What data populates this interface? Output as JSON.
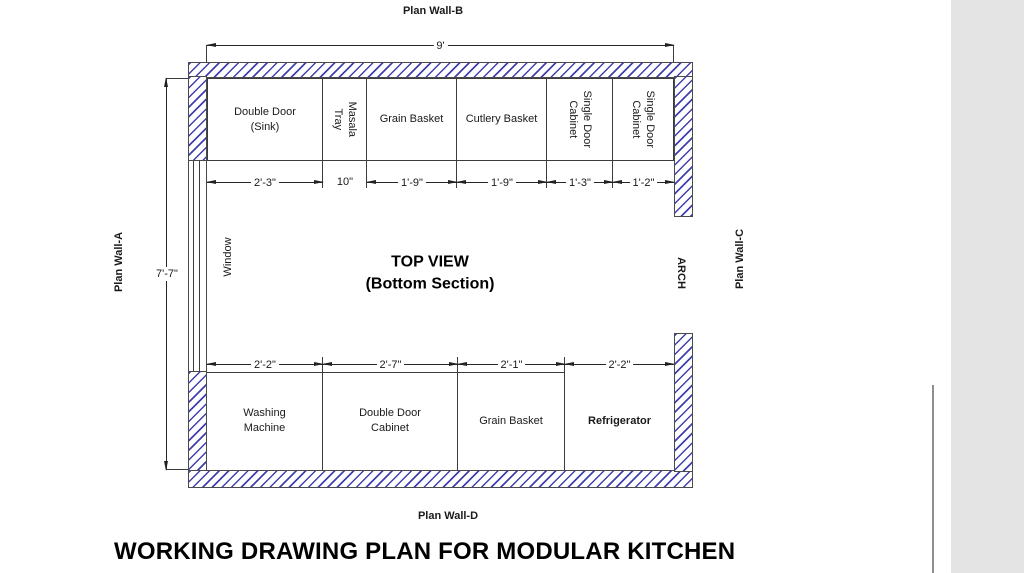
{
  "drawing": {
    "sheet_title": "WORKING DRAWING PLAN FOR MODULAR KITCHEN",
    "view_title": "TOP VIEW\n(Bottom Section)",
    "walls": {
      "top": "Plan Wall-B",
      "left": "Plan Wall-A",
      "right": "Plan Wall-C",
      "bottom": "Plan Wall-D"
    },
    "overall_dims": {
      "width": "9'",
      "height": "7'-7\""
    },
    "openings": {
      "window": "Window",
      "arch": "ARCH"
    },
    "top_row": {
      "cabinets": [
        {
          "label": "Double Door\n(Sink)",
          "width": "2'-3\""
        },
        {
          "label": "Masala Tray",
          "width": "10\""
        },
        {
          "label": "Grain Basket",
          "width": "1'-9\""
        },
        {
          "label": "Cutlery Basket",
          "width": "1'-9\""
        },
        {
          "label": "Single Door\nCabinet",
          "width": "1'-3\""
        },
        {
          "label": "Single Door\nCabinet",
          "width": "1'-2\""
        }
      ]
    },
    "bottom_row": {
      "cabinets": [
        {
          "label": "Washing\nMachine",
          "width": "2'-2\""
        },
        {
          "label": "Double Door\nCabinet",
          "width": "2'-7\""
        },
        {
          "label": "Grain Basket",
          "width": "2'-1\""
        },
        {
          "label": "Refrigerator",
          "width": "2'-2\""
        }
      ]
    },
    "colors": {
      "hatch_blue": "#4040b0",
      "outline_dark": "#4a4a4a"
    }
  }
}
